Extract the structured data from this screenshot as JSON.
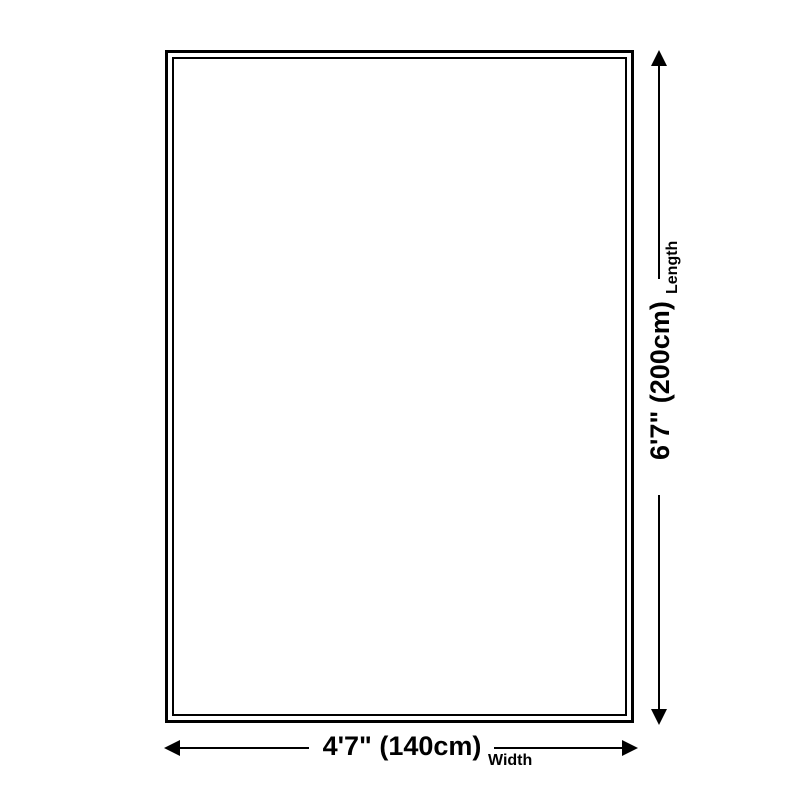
{
  "page": {
    "background_color": "#ffffff",
    "line_color": "#000000"
  },
  "diagram": {
    "type": "size-diagram",
    "length": {
      "label": "Length",
      "value": "6'7\" (200cm)"
    },
    "width": {
      "label": "Width",
      "value": "4'7\" (140cm)"
    },
    "icons": {
      "up": "arrow-up-icon",
      "down": "arrow-down-icon",
      "left": "arrow-left-icon",
      "right": "arrow-right-icon"
    }
  }
}
